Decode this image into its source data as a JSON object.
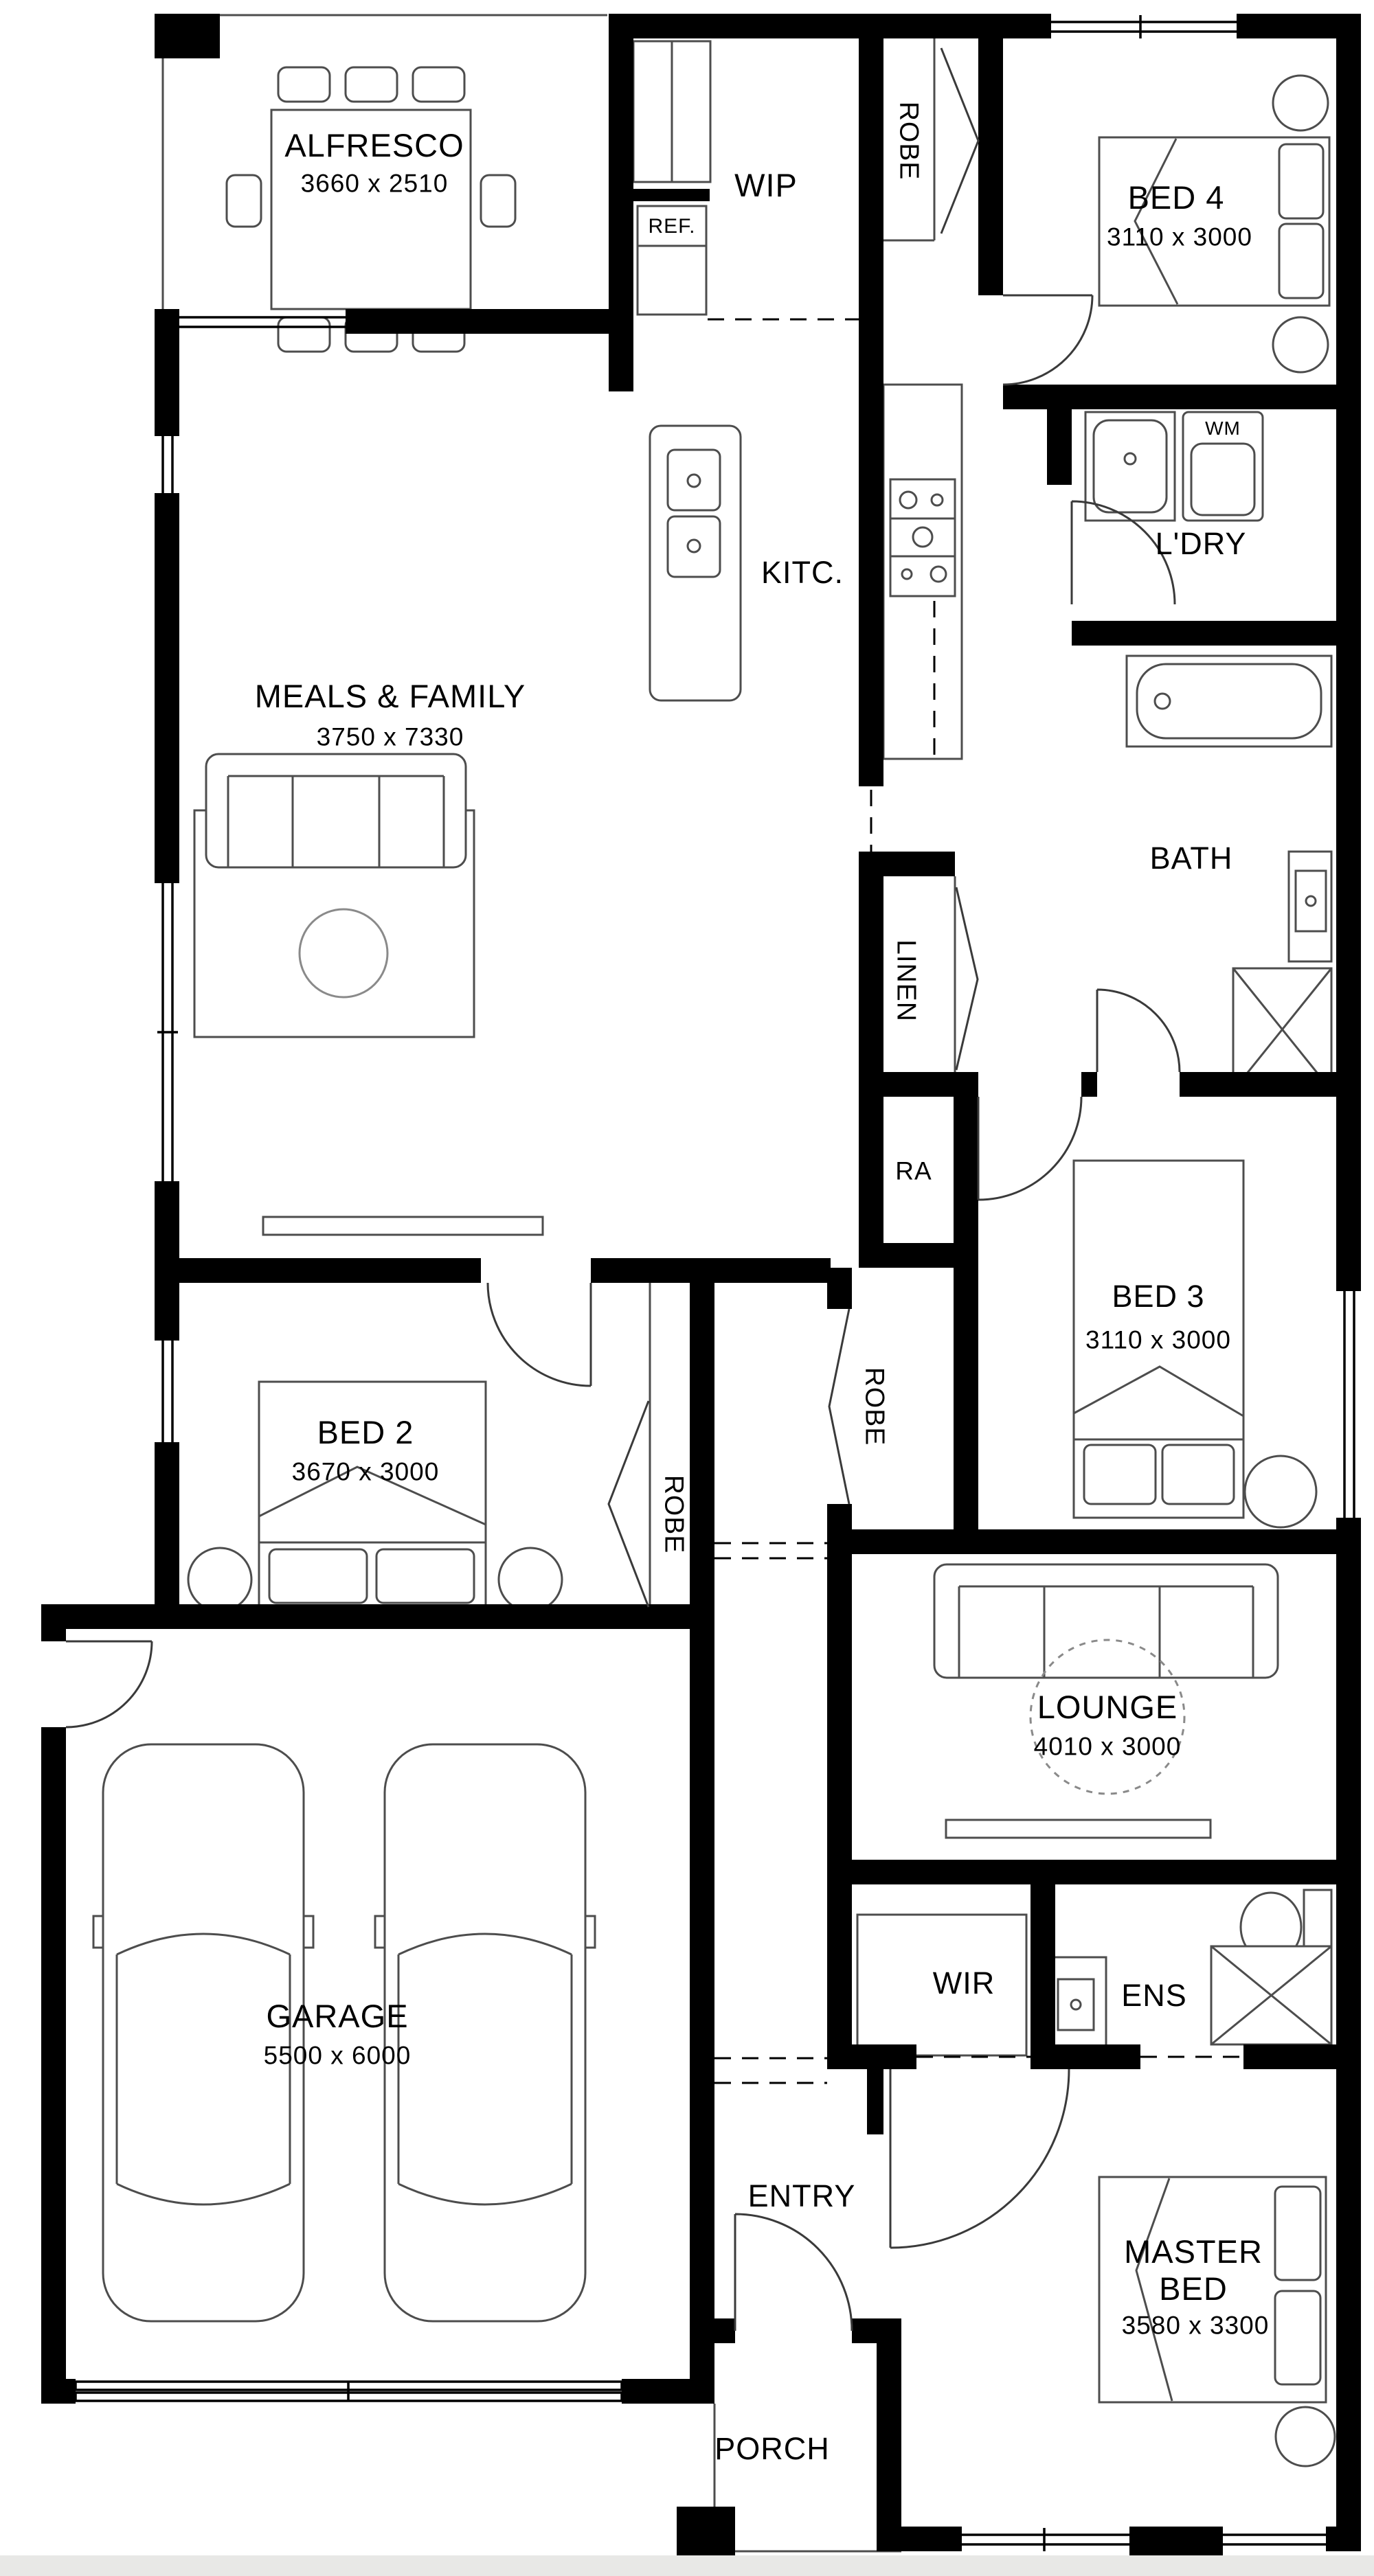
{
  "document": {
    "type": "residential floor plan",
    "style": "black and white architectural drawing"
  },
  "colors": {
    "wall": "#000000",
    "thin_line": "#4d4d4d",
    "light_line": "#8a8a8a",
    "text": "#000000",
    "paper": "#ffffff",
    "paper_edge": "#e8e8e6"
  },
  "rooms": [
    {
      "id": "alfresco",
      "name": "ALFRESCO",
      "dims": "3660 x 2510"
    },
    {
      "id": "wip",
      "name": "WIP"
    },
    {
      "id": "bed4",
      "name": "BED 4",
      "dims": "3110 x 3000"
    },
    {
      "id": "kitchen",
      "name": "KITC."
    },
    {
      "id": "laundry",
      "name": "L'DRY"
    },
    {
      "id": "meals_family",
      "name": "MEALS & FAMILY",
      "dims": "3750 x 7330"
    },
    {
      "id": "bath",
      "name": "BATH"
    },
    {
      "id": "linen",
      "name": "LINEN"
    },
    {
      "id": "return_air",
      "name": "RA"
    },
    {
      "id": "bed3",
      "name": "BED 3",
      "dims": "3110 x 3000"
    },
    {
      "id": "bed2",
      "name": "BED 2",
      "dims": "3670 x 3000"
    },
    {
      "id": "lounge",
      "name": "LOUNGE",
      "dims": "4010 x 3000"
    },
    {
      "id": "garage",
      "name": "GARAGE",
      "dims": "5500 x 6000"
    },
    {
      "id": "wir",
      "name": "WIR"
    },
    {
      "id": "ens",
      "name": "ENS"
    },
    {
      "id": "entry",
      "name": "ENTRY"
    },
    {
      "id": "master_bed",
      "name": "MASTER BED",
      "dims": "3580 x 3300"
    },
    {
      "id": "porch",
      "name": "PORCH"
    }
  ],
  "fixtures": [
    {
      "id": "fridge",
      "label": "REF."
    },
    {
      "id": "washing_machine",
      "label": "WM"
    },
    {
      "id": "robe_hall",
      "label": "ROBE"
    },
    {
      "id": "robe_bed3",
      "label": "ROBE"
    },
    {
      "id": "robe_bed2",
      "label": "ROBE"
    }
  ]
}
